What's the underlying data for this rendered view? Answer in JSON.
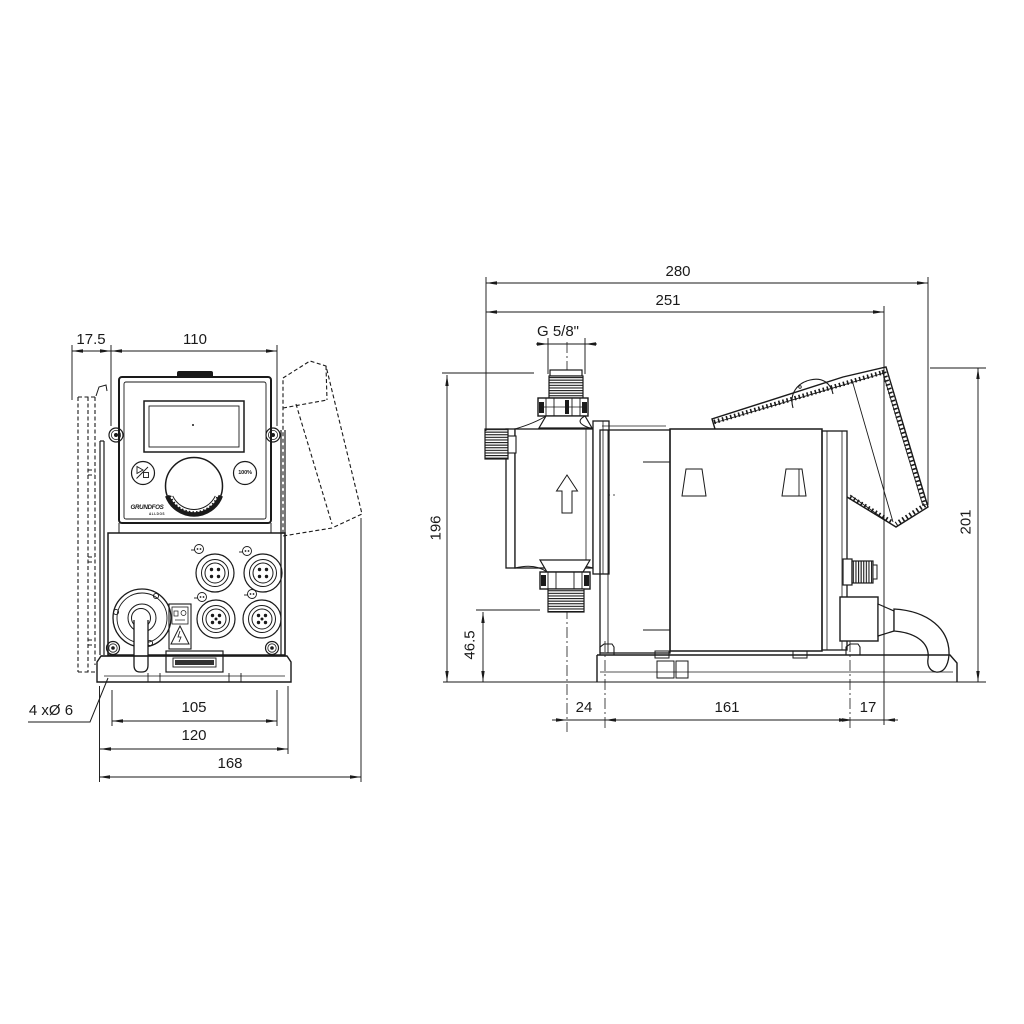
{
  "colors": {
    "line": "#1a1a1a",
    "background": "#ffffff"
  },
  "front_view": {
    "dimensions": {
      "wall_bracket_offset": "17.5",
      "control_panel_width": "110",
      "mounting_hole_spacing": "105",
      "mounting_plate_width": "120",
      "overall_width": "168",
      "mounting_holes_label": "4 xØ 6"
    },
    "control_panel": {
      "capacity_button_label": "100%",
      "logo_text": "GRUNDFOS",
      "logo_subtext": "ALLDOS"
    }
  },
  "side_view": {
    "dimensions": {
      "overall_depth": "280",
      "depth_to_control_cube": "251",
      "connection_thread": "G 5/8\"",
      "height_to_connection": "196",
      "connection_clearance_height": "46.5",
      "overall_height": "201",
      "head_center_to_first_hole": "24",
      "mounting_hole_spacing": "161",
      "hole_to_rear_edge": "17"
    }
  }
}
